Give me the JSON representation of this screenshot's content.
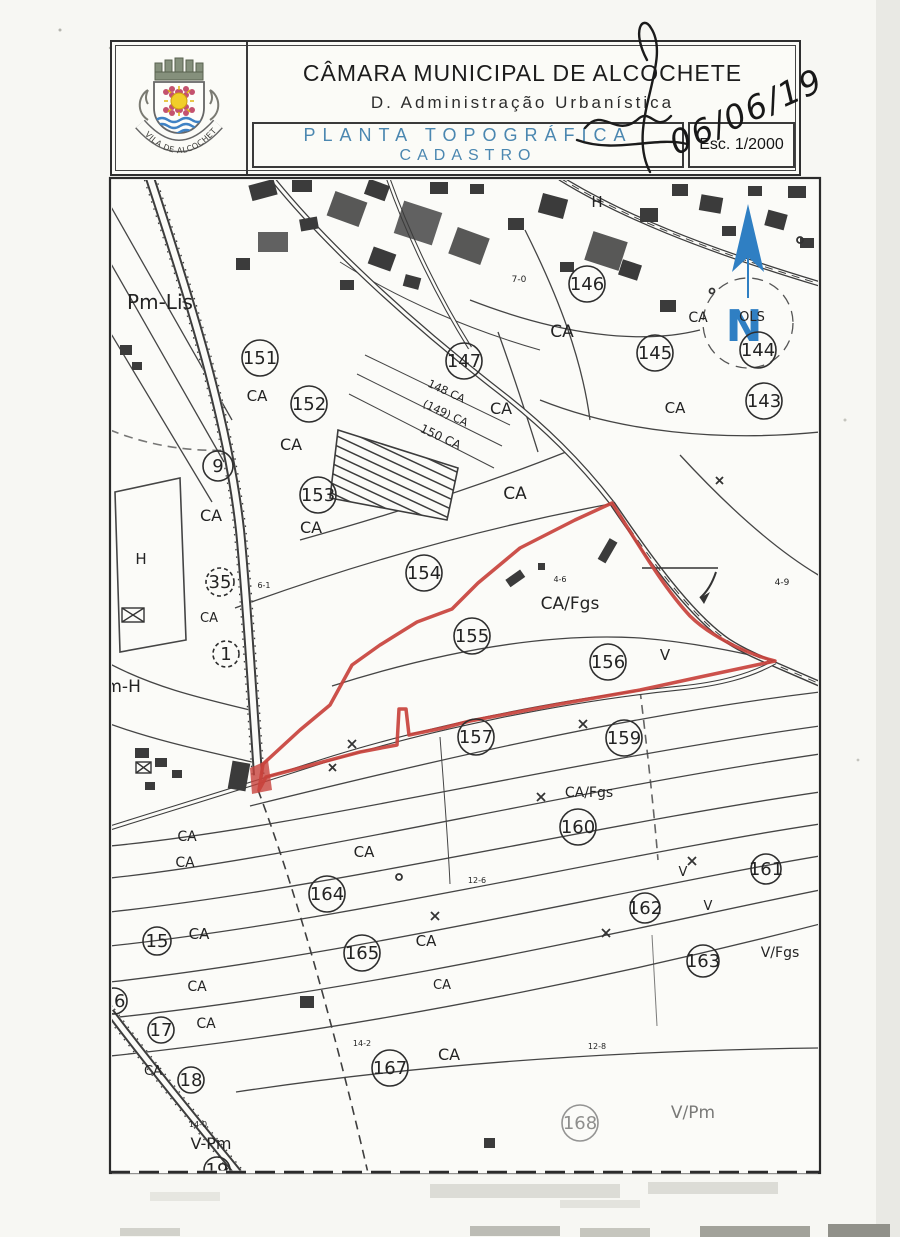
{
  "header": {
    "municipality": "CÂMARA MUNICIPAL DE ALCOCHETE",
    "department": "D. Administração Urbanística",
    "doc_title_line1": "PLANTA TOPOGRÁFICA",
    "doc_title_line2": "CADASTRO",
    "scale_label": "Esc. 1/2000",
    "handwritten_date": "06/06/19",
    "crest_motto": "VILA DE ALCOCHETE",
    "title_blue": "#4b87b0"
  },
  "map": {
    "north_label": "N",
    "accent_red": "#c8423c",
    "north_blue": "#2f7fc3",
    "labels": [
      {
        "t": "Pm-Lis",
        "x": 160,
        "y": 304,
        "s": 20
      },
      {
        "t": "151",
        "x": 260,
        "y": 358,
        "c": 1
      },
      {
        "t": "CA",
        "x": 257,
        "y": 396,
        "s": 15
      },
      {
        "t": "152",
        "x": 309,
        "y": 404,
        "c": 1
      },
      {
        "t": "CA",
        "x": 291,
        "y": 445,
        "s": 16
      },
      {
        "t": "9",
        "x": 218,
        "y": 466,
        "c": 1,
        "r": 15
      },
      {
        "t": "CA",
        "x": 211,
        "y": 516,
        "s": 16
      },
      {
        "t": "153",
        "x": 318,
        "y": 495,
        "c": 1
      },
      {
        "t": "CA",
        "x": 311,
        "y": 528,
        "s": 16
      },
      {
        "t": "147",
        "x": 464,
        "y": 361,
        "c": 1
      },
      {
        "t": "148 CA",
        "x": 447,
        "y": 390,
        "s": 11,
        "rot": 25
      },
      {
        "t": "(149) CA",
        "x": 446,
        "y": 412,
        "s": 11,
        "rot": 25
      },
      {
        "t": "150 CA",
        "x": 441,
        "y": 436,
        "s": 12,
        "rot": 25
      },
      {
        "t": "CA",
        "x": 501,
        "y": 409,
        "s": 16
      },
      {
        "t": "H",
        "x": 597,
        "y": 202,
        "s": 15
      },
      {
        "t": "7-0",
        "x": 519,
        "y": 277,
        "s": 9
      },
      {
        "t": "146",
        "x": 587,
        "y": 284,
        "c": 1
      },
      {
        "t": "CA",
        "x": 562,
        "y": 332,
        "s": 17
      },
      {
        "t": "145",
        "x": 655,
        "y": 353,
        "c": 1
      },
      {
        "t": "144",
        "x": 758,
        "y": 350,
        "c": 1
      },
      {
        "t": "143",
        "x": 764,
        "y": 401,
        "c": 1
      },
      {
        "t": "CA",
        "x": 675,
        "y": 408,
        "s": 15
      },
      {
        "t": "CA",
        "x": 698,
        "y": 317,
        "s": 14
      },
      {
        "t": "OLS",
        "x": 752,
        "y": 316,
        "s": 13
      },
      {
        "t": "CA",
        "x": 515,
        "y": 494,
        "s": 17
      },
      {
        "t": "154",
        "x": 424,
        "y": 573,
        "c": 1
      },
      {
        "t": "155",
        "x": 472,
        "y": 636,
        "c": 1
      },
      {
        "t": "CA/Fgs",
        "x": 570,
        "y": 604,
        "s": 17
      },
      {
        "t": "4-6",
        "x": 560,
        "y": 577,
        "s": 8
      },
      {
        "t": "156",
        "x": 608,
        "y": 662,
        "c": 1
      },
      {
        "t": "V",
        "x": 665,
        "y": 655,
        "s": 15
      },
      {
        "t": "4-9",
        "x": 782,
        "y": 580,
        "s": 9
      },
      {
        "t": "157",
        "x": 476,
        "y": 737,
        "c": 1
      },
      {
        "t": "159",
        "x": 624,
        "y": 738,
        "c": 1
      },
      {
        "t": "CA/Fgs",
        "x": 589,
        "y": 792,
        "s": 14
      },
      {
        "t": "160",
        "x": 578,
        "y": 827,
        "c": 1
      },
      {
        "t": "CA",
        "x": 187,
        "y": 836,
        "s": 14
      },
      {
        "t": "CA",
        "x": 185,
        "y": 862,
        "s": 14
      },
      {
        "t": "CA",
        "x": 364,
        "y": 852,
        "s": 15
      },
      {
        "t": "164",
        "x": 327,
        "y": 894,
        "c": 1
      },
      {
        "t": "12-6",
        "x": 477,
        "y": 878,
        "s": 8
      },
      {
        "t": "V",
        "x": 683,
        "y": 871,
        "s": 13
      },
      {
        "t": "161",
        "x": 766,
        "y": 869,
        "c": 1,
        "r": 15
      },
      {
        "t": "162",
        "x": 645,
        "y": 908,
        "c": 1,
        "r": 15
      },
      {
        "t": "V",
        "x": 708,
        "y": 905,
        "s": 13
      },
      {
        "t": "163",
        "x": 703,
        "y": 961,
        "c": 1,
        "r": 16
      },
      {
        "t": "V/Fgs",
        "x": 780,
        "y": 952,
        "s": 14
      },
      {
        "t": "15",
        "x": 157,
        "y": 941,
        "c": 1,
        "r": 14
      },
      {
        "t": "CA",
        "x": 199,
        "y": 934,
        "s": 15
      },
      {
        "t": "165",
        "x": 362,
        "y": 953,
        "c": 1
      },
      {
        "t": "CA",
        "x": 426,
        "y": 941,
        "s": 15
      },
      {
        "t": "CA",
        "x": 197,
        "y": 986,
        "s": 14
      },
      {
        "t": "16",
        "x": 114,
        "y": 1001,
        "c": 1,
        "r": 13
      },
      {
        "t": "CA",
        "x": 442,
        "y": 984,
        "s": 13
      },
      {
        "t": "17",
        "x": 161,
        "y": 1030,
        "c": 1,
        "r": 13
      },
      {
        "t": "CA",
        "x": 206,
        "y": 1023,
        "s": 14
      },
      {
        "t": "CA",
        "x": 153,
        "y": 1070,
        "s": 13
      },
      {
        "t": "18",
        "x": 191,
        "y": 1080,
        "c": 1,
        "r": 13
      },
      {
        "t": "14-2",
        "x": 362,
        "y": 1041,
        "s": 8
      },
      {
        "t": "167",
        "x": 390,
        "y": 1068,
        "c": 1
      },
      {
        "t": "CA",
        "x": 449,
        "y": 1055,
        "s": 16
      },
      {
        "t": "12-8",
        "x": 597,
        "y": 1044,
        "s": 8
      },
      {
        "t": "168",
        "x": 580,
        "y": 1123,
        "c": 1,
        "f": 0.5
      },
      {
        "t": "V/Pm",
        "x": 693,
        "y": 1113,
        "s": 17,
        "f": 0.6
      },
      {
        "t": "14-0",
        "x": 198,
        "y": 1122,
        "s": 8
      },
      {
        "t": "V-Pm",
        "x": 211,
        "y": 1144,
        "s": 16
      },
      {
        "t": "19",
        "x": 217,
        "y": 1170,
        "c": 1,
        "r": 13
      },
      {
        "t": "35",
        "x": 220,
        "y": 582,
        "c": 1,
        "r": 14,
        "dash": 1
      },
      {
        "t": "CA",
        "x": 209,
        "y": 617,
        "s": 13
      },
      {
        "t": "1",
        "x": 226,
        "y": 654,
        "c": 1,
        "r": 13,
        "dash": 1
      },
      {
        "t": "H",
        "x": 141,
        "y": 559,
        "s": 15
      },
      {
        "t": "Pm-H",
        "x": 118,
        "y": 687,
        "s": 17
      },
      {
        "t": "6-1",
        "x": 264,
        "y": 583,
        "s": 8
      }
    ]
  }
}
